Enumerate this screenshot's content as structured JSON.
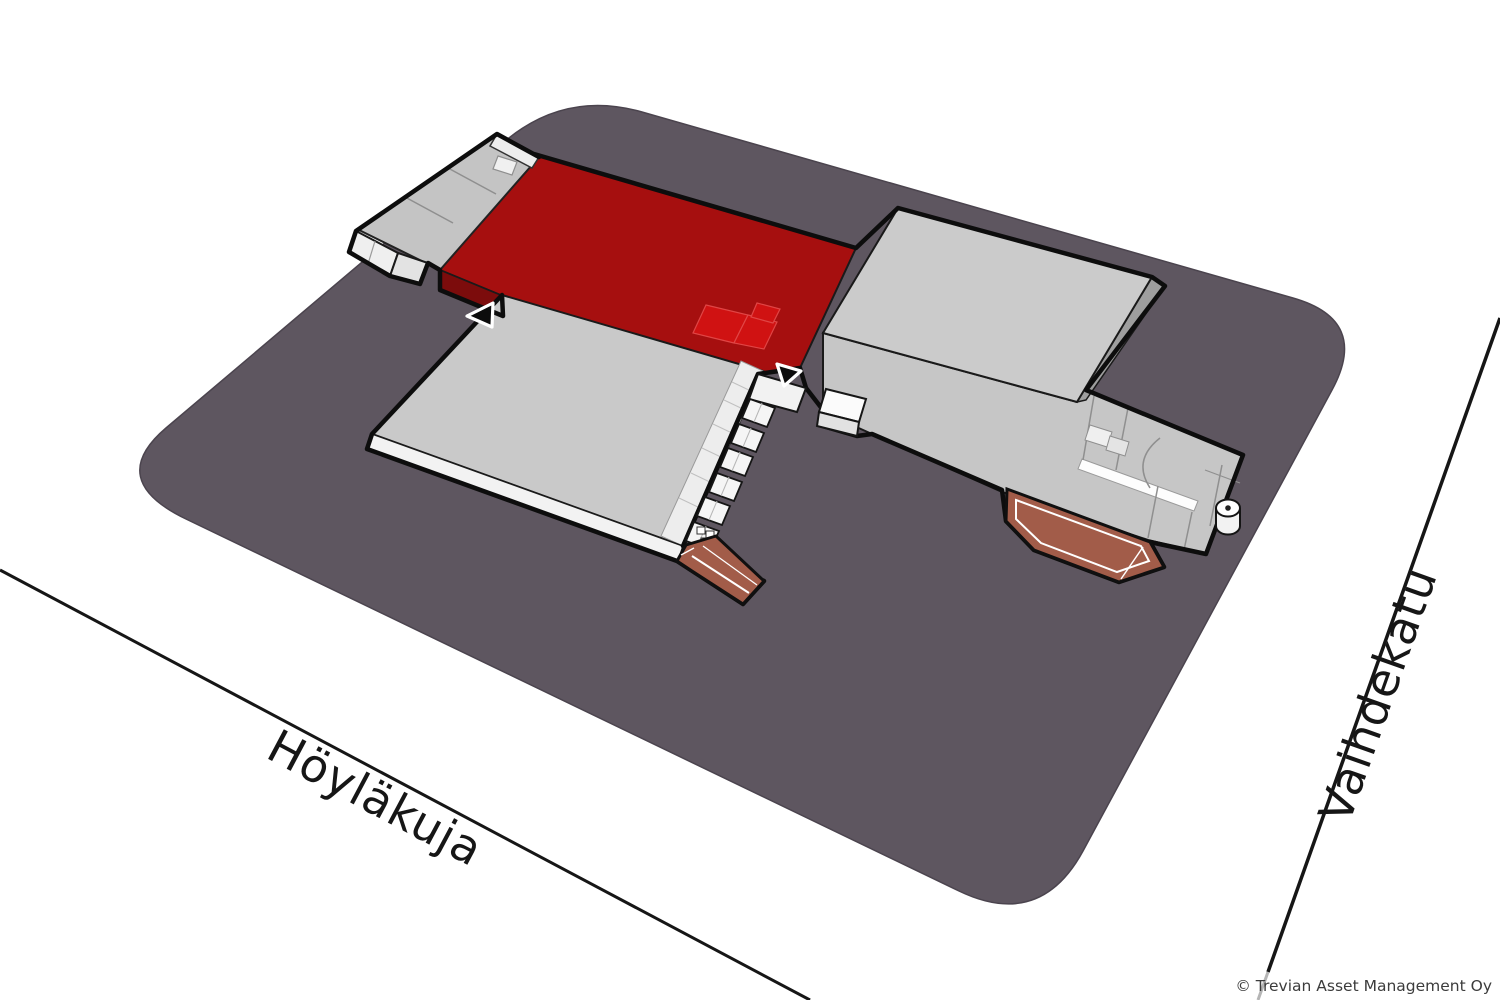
{
  "streets": [
    {
      "id": "hoylakuja",
      "label": "Höyläkuja"
    },
    {
      "id": "vaihdekatu",
      "label": "Vaihdekatu"
    }
  ],
  "copyright": "© Trevian Asset Management Oy",
  "colors": {
    "plot": "#5e5660",
    "plot_edge": "#4b444e",
    "building_roof": "#c9c9c9",
    "building_roof_tall": "#cbcbcb",
    "building_side": "#9e9e9e",
    "building_face": "#f2f2f2",
    "strip_roof": "#c4c4c4",
    "highlight_roof": "#a60f0f",
    "highlight_face": "#7c0c0c",
    "highlight_panel": "#d01212",
    "ramp": "#a25c49",
    "outline": "#0d0d0d",
    "street_line": "#161616",
    "label": "#161616",
    "copyright": "#3c3c3c"
  }
}
